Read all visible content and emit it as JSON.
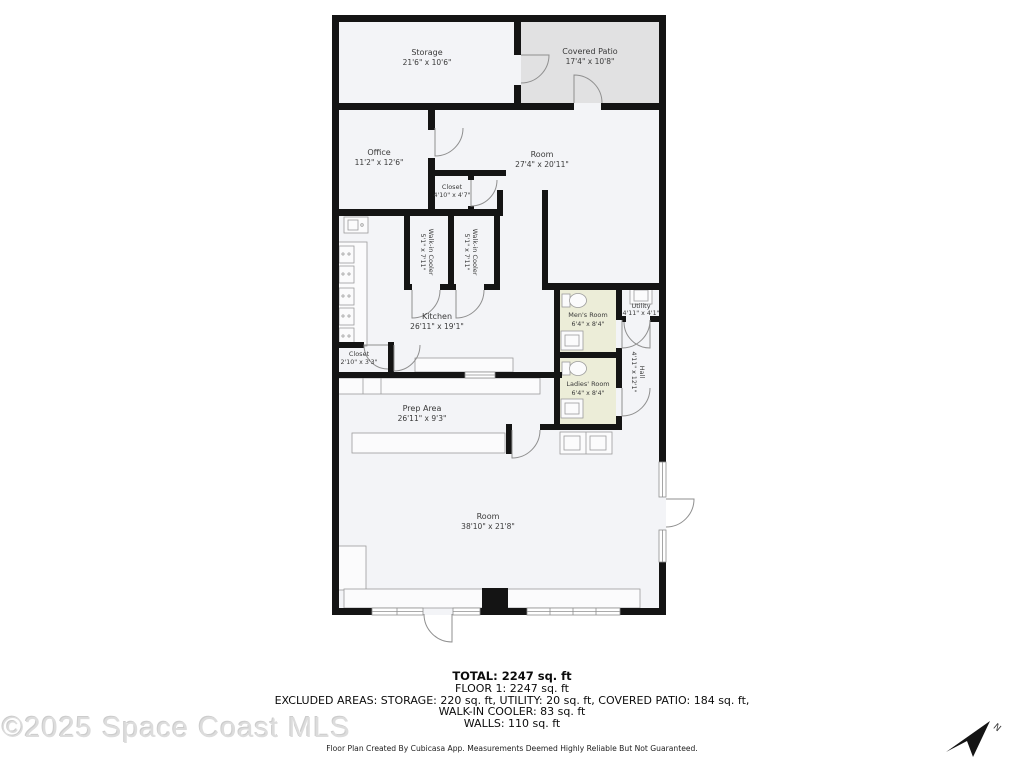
{
  "floorplan": {
    "rooms": {
      "storage": {
        "name": "Storage",
        "dims": "21'6\" x 10'6\""
      },
      "covered_patio": {
        "name": "Covered Patio",
        "dims": "17'4\" x 10'8\""
      },
      "office": {
        "name": "Office",
        "dims": "11'2\" x 12'6\""
      },
      "room_upper": {
        "name": "Room",
        "dims": "27'4\" x 20'11\""
      },
      "closet_upper": {
        "name": "Closet",
        "dims": "4'10\" x 4'7\""
      },
      "walk_in_cooler_1": {
        "name": "Walk-in Cooler",
        "dims": "5'1\" x 7'11\""
      },
      "walk_in_cooler_2": {
        "name": "Walk-in Cooler",
        "dims": "5'1\" x 7'11\""
      },
      "kitchen": {
        "name": "Kitchen",
        "dims": "26'11\" x 19'1\""
      },
      "mens_room": {
        "name": "Men's Room",
        "dims": "6'4\" x 8'4\""
      },
      "utility": {
        "name": "Utility",
        "dims": "4'11\" x 4'1\""
      },
      "hall": {
        "name": "Hall",
        "dims": "4'11\" x 12'1\""
      },
      "ladies_room": {
        "name": "Ladies' Room",
        "dims": "6'4\" x 8'4\""
      },
      "closet_lower": {
        "name": "Closet",
        "dims": "2'10\" x 3'3\""
      },
      "prep_area": {
        "name": "Prep Area",
        "dims": "26'11\" x 9'3\""
      },
      "room_lower": {
        "name": "Room",
        "dims": "38'10\" x 21'8\""
      }
    },
    "summary": {
      "total": "TOTAL: 2247 sq. ft",
      "floor1": "FLOOR 1: 2247 sq. ft",
      "excluded1": "EXCLUDED AREAS: STORAGE: 220 sq. ft, UTILITY: 20 sq. ft, COVERED PATIO: 184 sq. ft,",
      "excluded2": "WALK-IN COOLER: 83 sq. ft",
      "walls": "WALLS: 110 sq. ft",
      "disclaimer": "Floor Plan Created By Cubicasa App. Measurements Deemed Highly Reliable But Not Guaranteed."
    },
    "watermark": "©2025 Space Coast MLS",
    "north_label": "N",
    "colors": {
      "wall": "#141414",
      "room_fill": "#f3f4f7",
      "patio_fill": "#e1e1e2",
      "bathroom_fill": "#ecedd8",
      "fixture_stroke": "#9c9c9c",
      "watermark": "#dcdcdc"
    }
  }
}
